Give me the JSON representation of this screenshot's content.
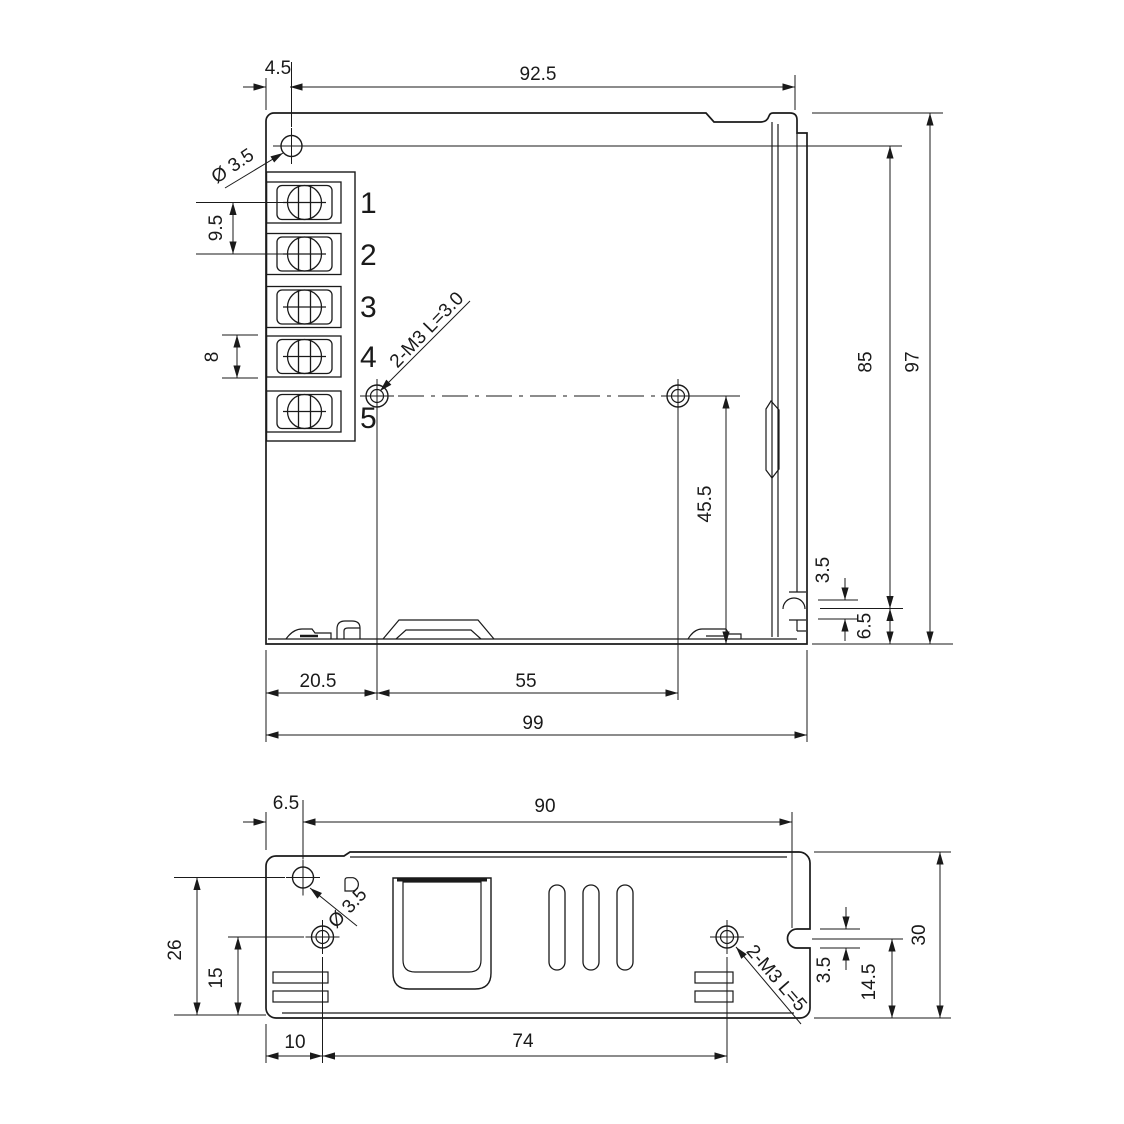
{
  "top_view": {
    "dims": {
      "hole_offset_x": "4.5",
      "body_width": "92.5",
      "terminal_pitch_large": "9.5",
      "terminal_pitch_small": "8",
      "mount_height": "85",
      "total_height": "97",
      "screw_hole_y": "45.5",
      "flange_slot": "3.5",
      "flange_hole_y": "6.5",
      "screw_hole_x": "20.5",
      "screw_hole_span": "55",
      "total_width": "99"
    },
    "notes": {
      "corner_hole": "Ø 3.5",
      "mount_screws": "2-M3 L=3.0"
    },
    "terminals": [
      "1",
      "2",
      "3",
      "4",
      "5"
    ]
  },
  "side_view": {
    "dims": {
      "hole_offset_x": "6.5",
      "body_width": "90",
      "hole_y": "26",
      "screw_hole_y": "15",
      "flange_slot": "3.5",
      "flange_slot_y": "14.5",
      "total_height": "30",
      "screw_hole_x": "10",
      "screw_hole_span": "74"
    },
    "notes": {
      "corner_hole": "Ø 3.5",
      "mount_screws": "2-M3 L=5"
    }
  }
}
